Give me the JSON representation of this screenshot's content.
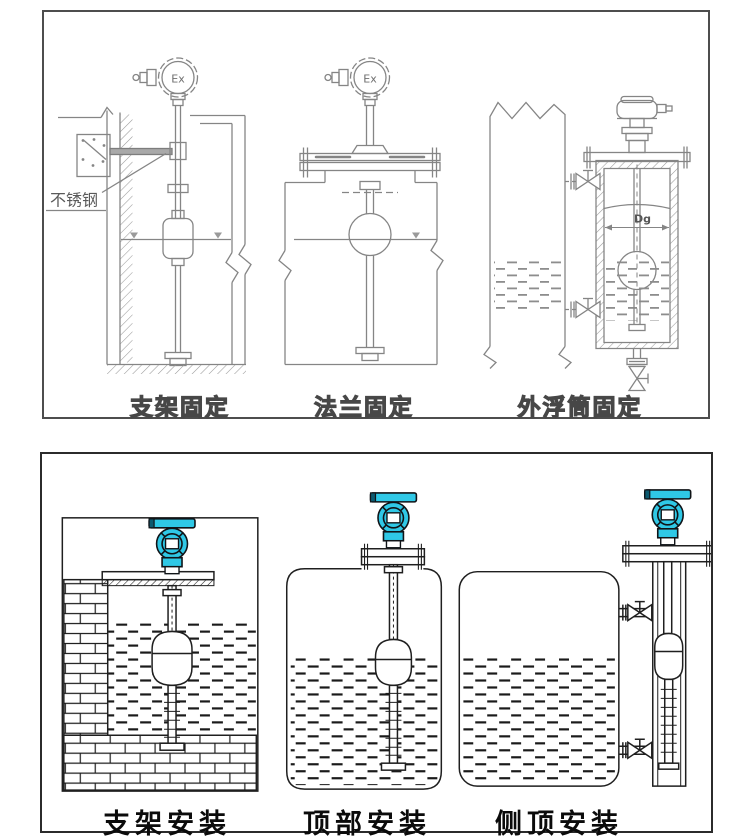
{
  "canvas": {
    "width": 750,
    "height": 840,
    "background": "#ffffff"
  },
  "colors": {
    "top_line_gray": "#858585",
    "bottom_line_black": "#1f1f1f",
    "transmitter_body_cyan": "#2fc8e6",
    "transmitter_shade": "#0c5a70",
    "panel_border_top": "#4d4d4d",
    "panel_border_bottom": "#2b2b2b"
  },
  "top_panel": {
    "labels": {
      "stainless_steel": "不锈钢",
      "ex_bracket": "Ex",
      "ex_flange": "Ex",
      "chamber_diameter": "Dg"
    },
    "captions": [
      {
        "label": "支架固定"
      },
      {
        "label": "法兰固定"
      },
      {
        "label": "外浮筒固定"
      }
    ]
  },
  "bottom_panel": {
    "captions": [
      {
        "label": "支架安装"
      },
      {
        "label": "顶部安装"
      },
      {
        "label": "侧顶安装"
      }
    ]
  }
}
